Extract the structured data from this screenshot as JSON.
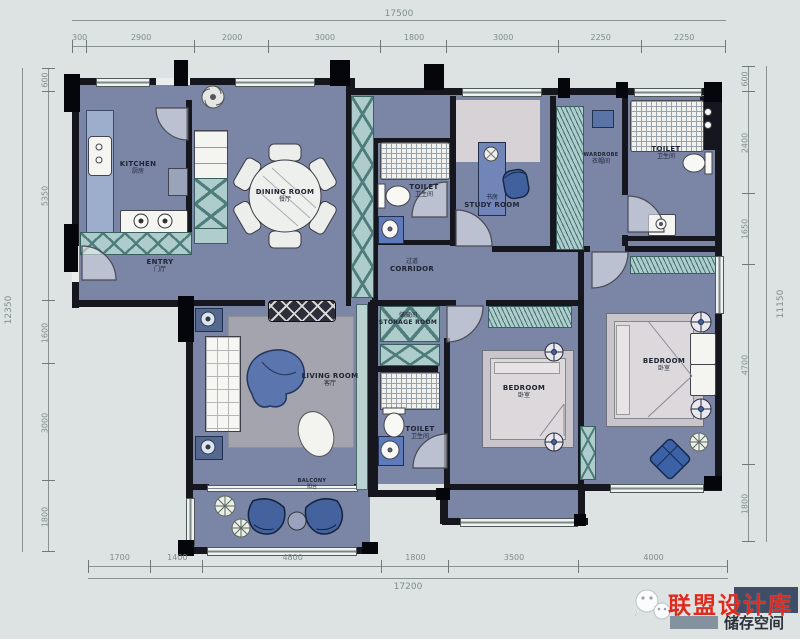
{
  "colors": {
    "background": "#dde3e2",
    "floor": "#7b86a6",
    "wall": "#16161f",
    "cabinet_teal": "#adcccb",
    "accent_blue": "#4a69a3",
    "watermark_red": "#e02a1e"
  },
  "dims": {
    "top": {
      "total": "17500",
      "segments": [
        "300",
        "2900",
        "2000",
        "3000",
        "1800",
        "3000",
        "2250",
        "2250"
      ]
    },
    "bottom": {
      "total": "17200",
      "segments": [
        "1700",
        "1400",
        "4800",
        "1800",
        "3500",
        "4000"
      ]
    },
    "left": {
      "total": "12350",
      "segments": [
        "600",
        "5350",
        "1600",
        "3000",
        "1800"
      ]
    },
    "right": {
      "total": "11150",
      "segments": [
        "600",
        "2400",
        "1650",
        "4700",
        "1800"
      ]
    }
  },
  "rooms": {
    "kitchen": {
      "en": "KITCHEN",
      "zh": "厨房"
    },
    "entry": {
      "en": "ENTRY",
      "zh": "门厅"
    },
    "dining": {
      "en": "DINING ROOM",
      "zh": "餐厅"
    },
    "toilet_mid": {
      "en": "TOILET",
      "zh": "卫生间"
    },
    "study": {
      "en": "STUDY ROOM",
      "zh": "书房"
    },
    "wardrobe": {
      "en": "WARDROBE",
      "zh": "衣帽间"
    },
    "toilet_top_right": {
      "en": "TOILET",
      "zh": "卫生间"
    },
    "corridor": {
      "en": "CORRIDOR",
      "zh": "过道"
    },
    "living": {
      "en": "LIVING ROOM",
      "zh": "客厅"
    },
    "storage": {
      "en": "STORAGE ROOM",
      "zh": "储藏间"
    },
    "toilet_bottom": {
      "en": "TOILET",
      "zh": "卫生间"
    },
    "bedroom_mid": {
      "en": "BEDROOM",
      "zh": "卧室"
    },
    "bedroom_right": {
      "en": "BEDROOM",
      "zh": "卧室"
    },
    "balcony": {
      "en": "BALCONY",
      "zh": "阳台"
    }
  },
  "watermark": {
    "brand": "联盟设计库",
    "subtitle": "储存空间"
  }
}
